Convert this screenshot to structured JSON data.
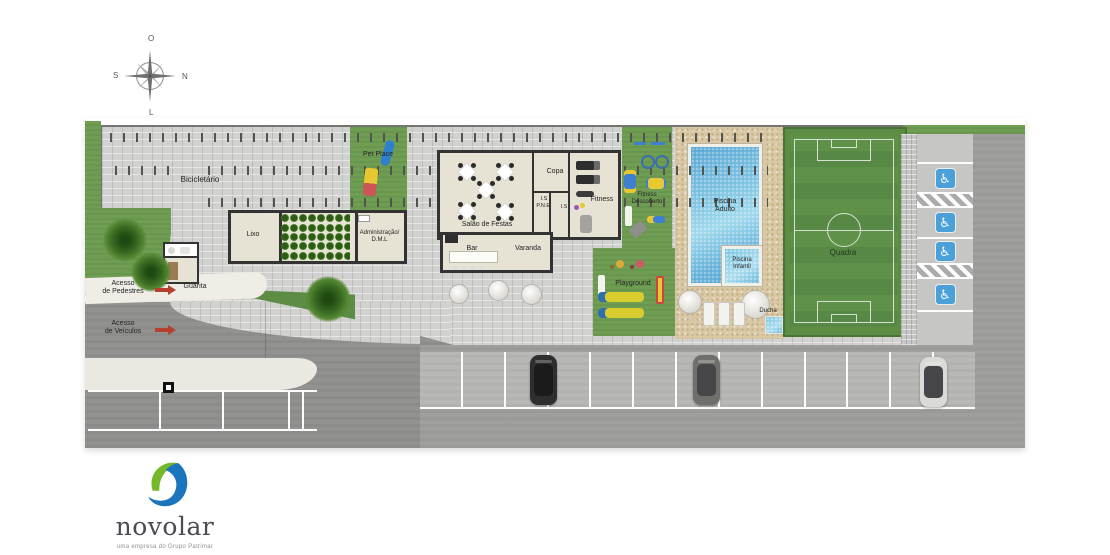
{
  "compass": {
    "top": "O",
    "right": "N",
    "bottom": "L",
    "left": "S"
  },
  "areas": {
    "bicicletario": "Bicicletário",
    "pet_place": "Pet Place",
    "lixo": "Lixo",
    "administracao": [
      "Administração/",
      "D.M.L"
    ],
    "salao_de_festas": "Salão de Festas",
    "copa": "Copa",
    "is_pne": [
      "I.S",
      "P.N.E."
    ],
    "is": "I.S",
    "fitness": "Fitness",
    "fitness_descoberto": [
      "Fitness",
      "Descoberto"
    ],
    "bar": "Bar",
    "varanda": "Varanda",
    "piscina_adulto": [
      "Piscina",
      "Adulto"
    ],
    "piscina_infantil": [
      "Piscina",
      "Infantil"
    ],
    "ducha": "Ducha",
    "playground": "Playground",
    "quadra": "Quadra",
    "guarita": "Guarita"
  },
  "access": {
    "pedestres": [
      "Acesso",
      "de Pedestres"
    ],
    "veiculos": [
      "Acesso",
      "de Veículos"
    ]
  },
  "parking": {
    "accessible_icon": "♿"
  },
  "logo": {
    "name": "novolar",
    "tagline": "uma empresa do Grupo Patrimar"
  },
  "colors": {
    "grass": "#6f9e53",
    "court_green": "#5d8f48",
    "water_blue": "#62aed6",
    "sand": "#d9c8a3",
    "paver_gray": "#d1d1cf",
    "asphalt_gray": "#9f9f9d",
    "arrow_red": "#b5402f",
    "accessible_blue": "#4aa0d8",
    "logo_green": "#76b82a",
    "logo_blue": "#1b75bc"
  }
}
